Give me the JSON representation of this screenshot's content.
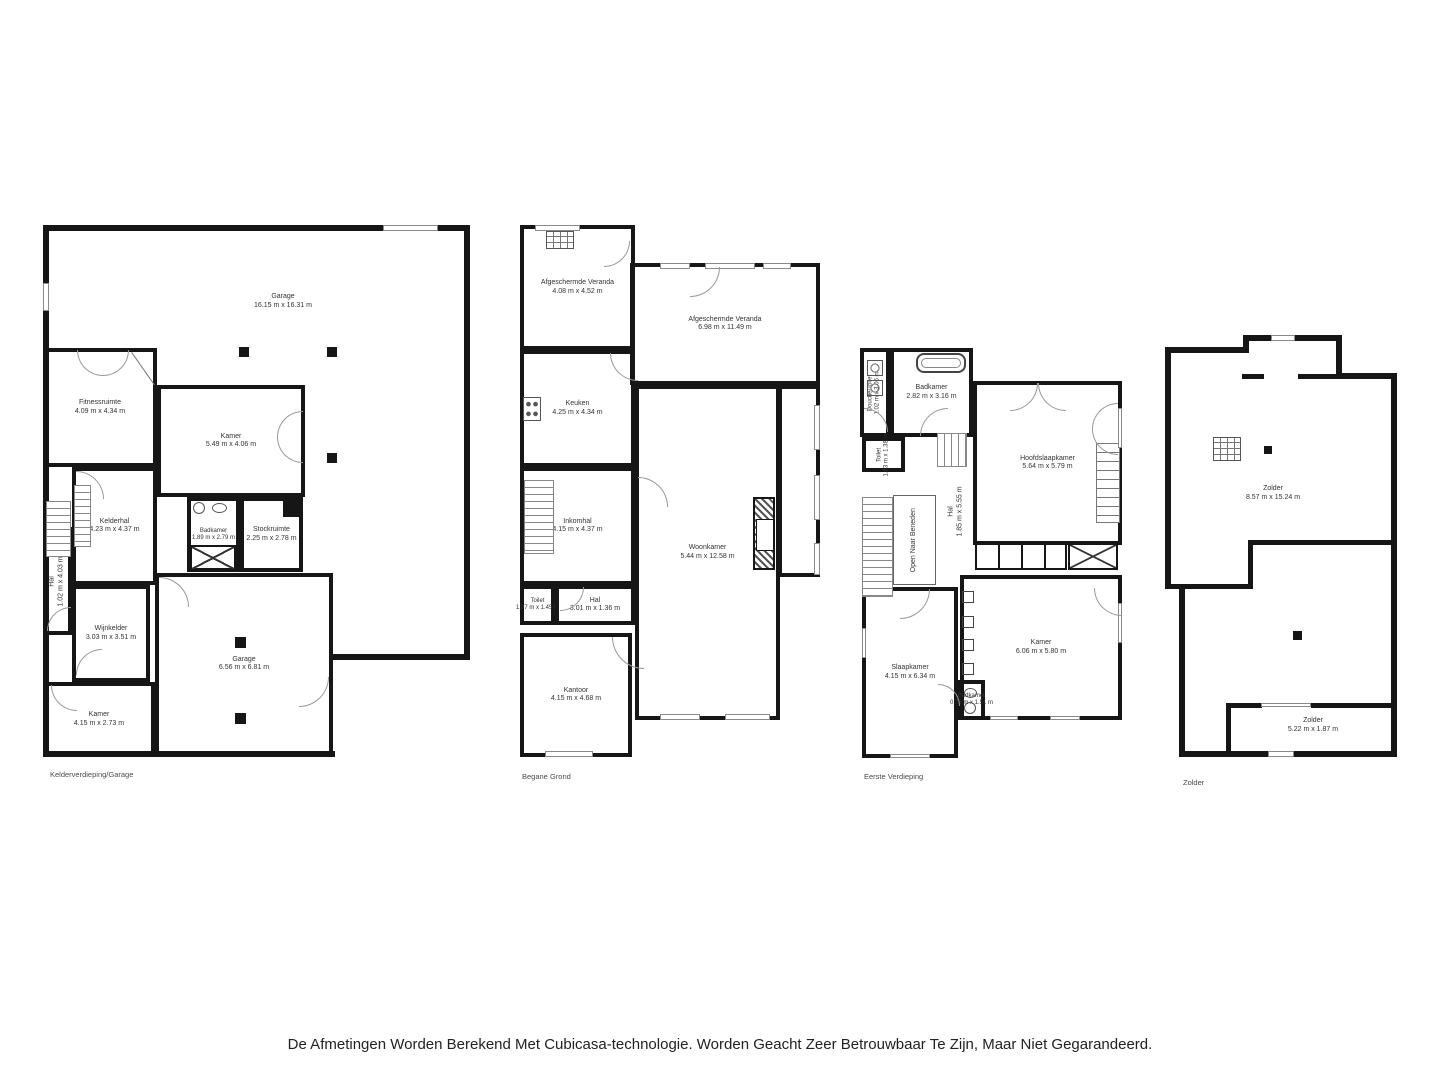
{
  "colors": {
    "wall": "#161616",
    "room_label": "#333333",
    "caption": "#4a4a4a",
    "disclaimer_text": "#222222",
    "background": "#ffffff"
  },
  "floors": [
    {
      "caption": "Kelderverdieping/Garage",
      "rooms": [
        {
          "name": "Garage",
          "dims": "16.15 m x 16.31 m"
        },
        {
          "name": "Fitnessruimte",
          "dims": "4.09 m x 4.34 m"
        },
        {
          "name": "Kamer",
          "dims": "5.49 m x 4.06 m"
        },
        {
          "name": "Kelderhal",
          "dims": "4.23 m x 4.37 m"
        },
        {
          "name": "Badkamer",
          "dims": "1.89 m x 2.79 m"
        },
        {
          "name": "Stockruimte",
          "dims": "2.25 m x 2.78 m"
        },
        {
          "name": "Hal",
          "dims": "1.02 m x 4.03 m"
        },
        {
          "name": "Wijnkelder",
          "dims": "3.03 m x 3.51 m"
        },
        {
          "name": "Kamer",
          "dims": "4.15 m x 2.73 m"
        },
        {
          "name": "Garage",
          "dims": "6.56 m x 6.81 m"
        }
      ]
    },
    {
      "caption": "Begane Grond",
      "rooms": [
        {
          "name": "Afgeschermde Veranda",
          "dims": "4.08 m x 4.52 m"
        },
        {
          "name": "Afgeschermde Veranda",
          "dims": "6.98 m x 11.49 m"
        },
        {
          "name": "Keuken",
          "dims": "4.25 m x 4.34 m"
        },
        {
          "name": "Inkomhal",
          "dims": "4.15 m x 4.37 m"
        },
        {
          "name": "Woonkamer",
          "dims": "5.44 m x 12.58 m"
        },
        {
          "name": "Toilet",
          "dims": "1.07 m x 1.45 m"
        },
        {
          "name": "Hal",
          "dims": "3.01 m x 1.36 m"
        },
        {
          "name": "Kantoor",
          "dims": "4.15 m x 4.68 m"
        }
      ]
    },
    {
      "caption": "Eerste  Verdieping",
      "rooms": [
        {
          "name": "Douche/Toilet",
          "dims": "1.02 m x 3.06 m"
        },
        {
          "name": "Badkamer",
          "dims": "2.82 m x 3.16 m"
        },
        {
          "name": "Hoofdslaapkamer",
          "dims": "5.64 m x 5.79 m"
        },
        {
          "name": "Toilet",
          "dims": "1.63 m x 1.38 m"
        },
        {
          "name": "Open Naar Beneden",
          "dims": ""
        },
        {
          "name": "Hal",
          "dims": "1.85 m x 5.55 m"
        },
        {
          "name": "Slaapkamer",
          "dims": "4.15 m x 6.34 m"
        },
        {
          "name": "Kamer",
          "dims": "6.06 m x 5.80 m"
        },
        {
          "name": "Badkamer",
          "dims": "0.76 m x 1.51 m"
        }
      ]
    },
    {
      "caption": "Zolder",
      "rooms": [
        {
          "name": "Zolder",
          "dims": "8.57 m x 15.24 m"
        },
        {
          "name": "Zolder",
          "dims": "5.22 m x 1.87 m"
        }
      ]
    }
  ],
  "disclaimer": "De Afmetingen Worden Berekend Met Cubicasa-technologie. Worden Geacht Zeer Betrouwbaar Te Zijn, Maar Niet Gegarandeerd."
}
